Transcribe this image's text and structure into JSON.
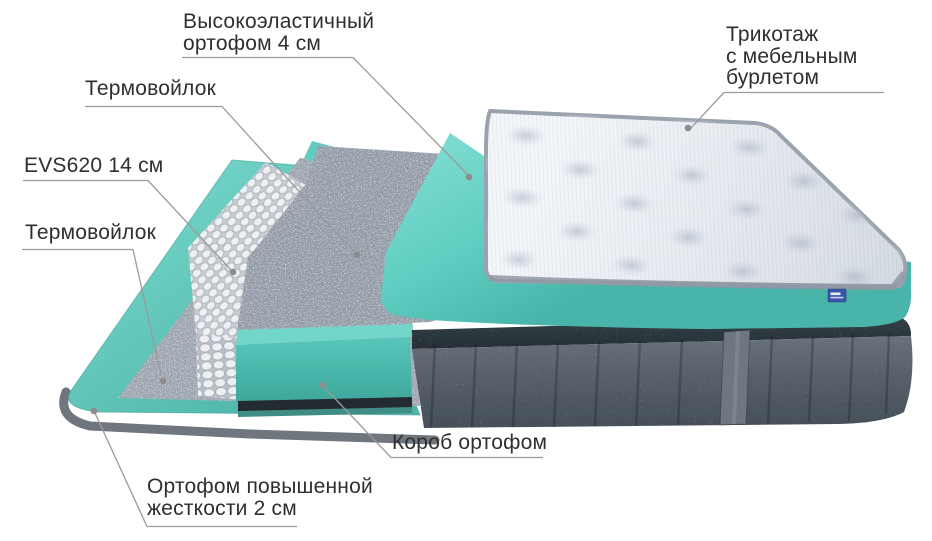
{
  "diagram": {
    "kind": "mattress-layers-exploded-view",
    "labels": {
      "hi_foam": {
        "line1": "Высокоэластичный",
        "line2": "ортофом 4 см"
      },
      "thermo_upper": {
        "line1": "Термовойлок"
      },
      "evs": {
        "line1": "EVS620 14 см"
      },
      "thermo_lower": {
        "line1": "Термовойлок"
      },
      "ortho_hard": {
        "line1": "Ортофом повышенной",
        "line2": "жесткости 2 см"
      },
      "korob": {
        "line1": "Короб ортофом"
      },
      "tricot": {
        "line1": "Трикотаж",
        "line2": "с мебельным",
        "line3": "бурлетом"
      }
    },
    "icons": {
      "brand_tag": "brand-tag"
    },
    "colors": {
      "teal_light": "#7edcd2",
      "teal_mid": "#5fcdc1",
      "teal_dark": "#45aea2",
      "felt_gray": "#97a0ab",
      "springs_white": "#eef0f2",
      "velvet_gray": "#57606a",
      "top_band_dark": "#2d383e",
      "quilt_white": "#f4f6f9",
      "quilt_border": "#99a2ad",
      "text": "#2f2f2f",
      "leader_line": "#9b9b9b",
      "tag_blue": "#3a55a8"
    }
  }
}
